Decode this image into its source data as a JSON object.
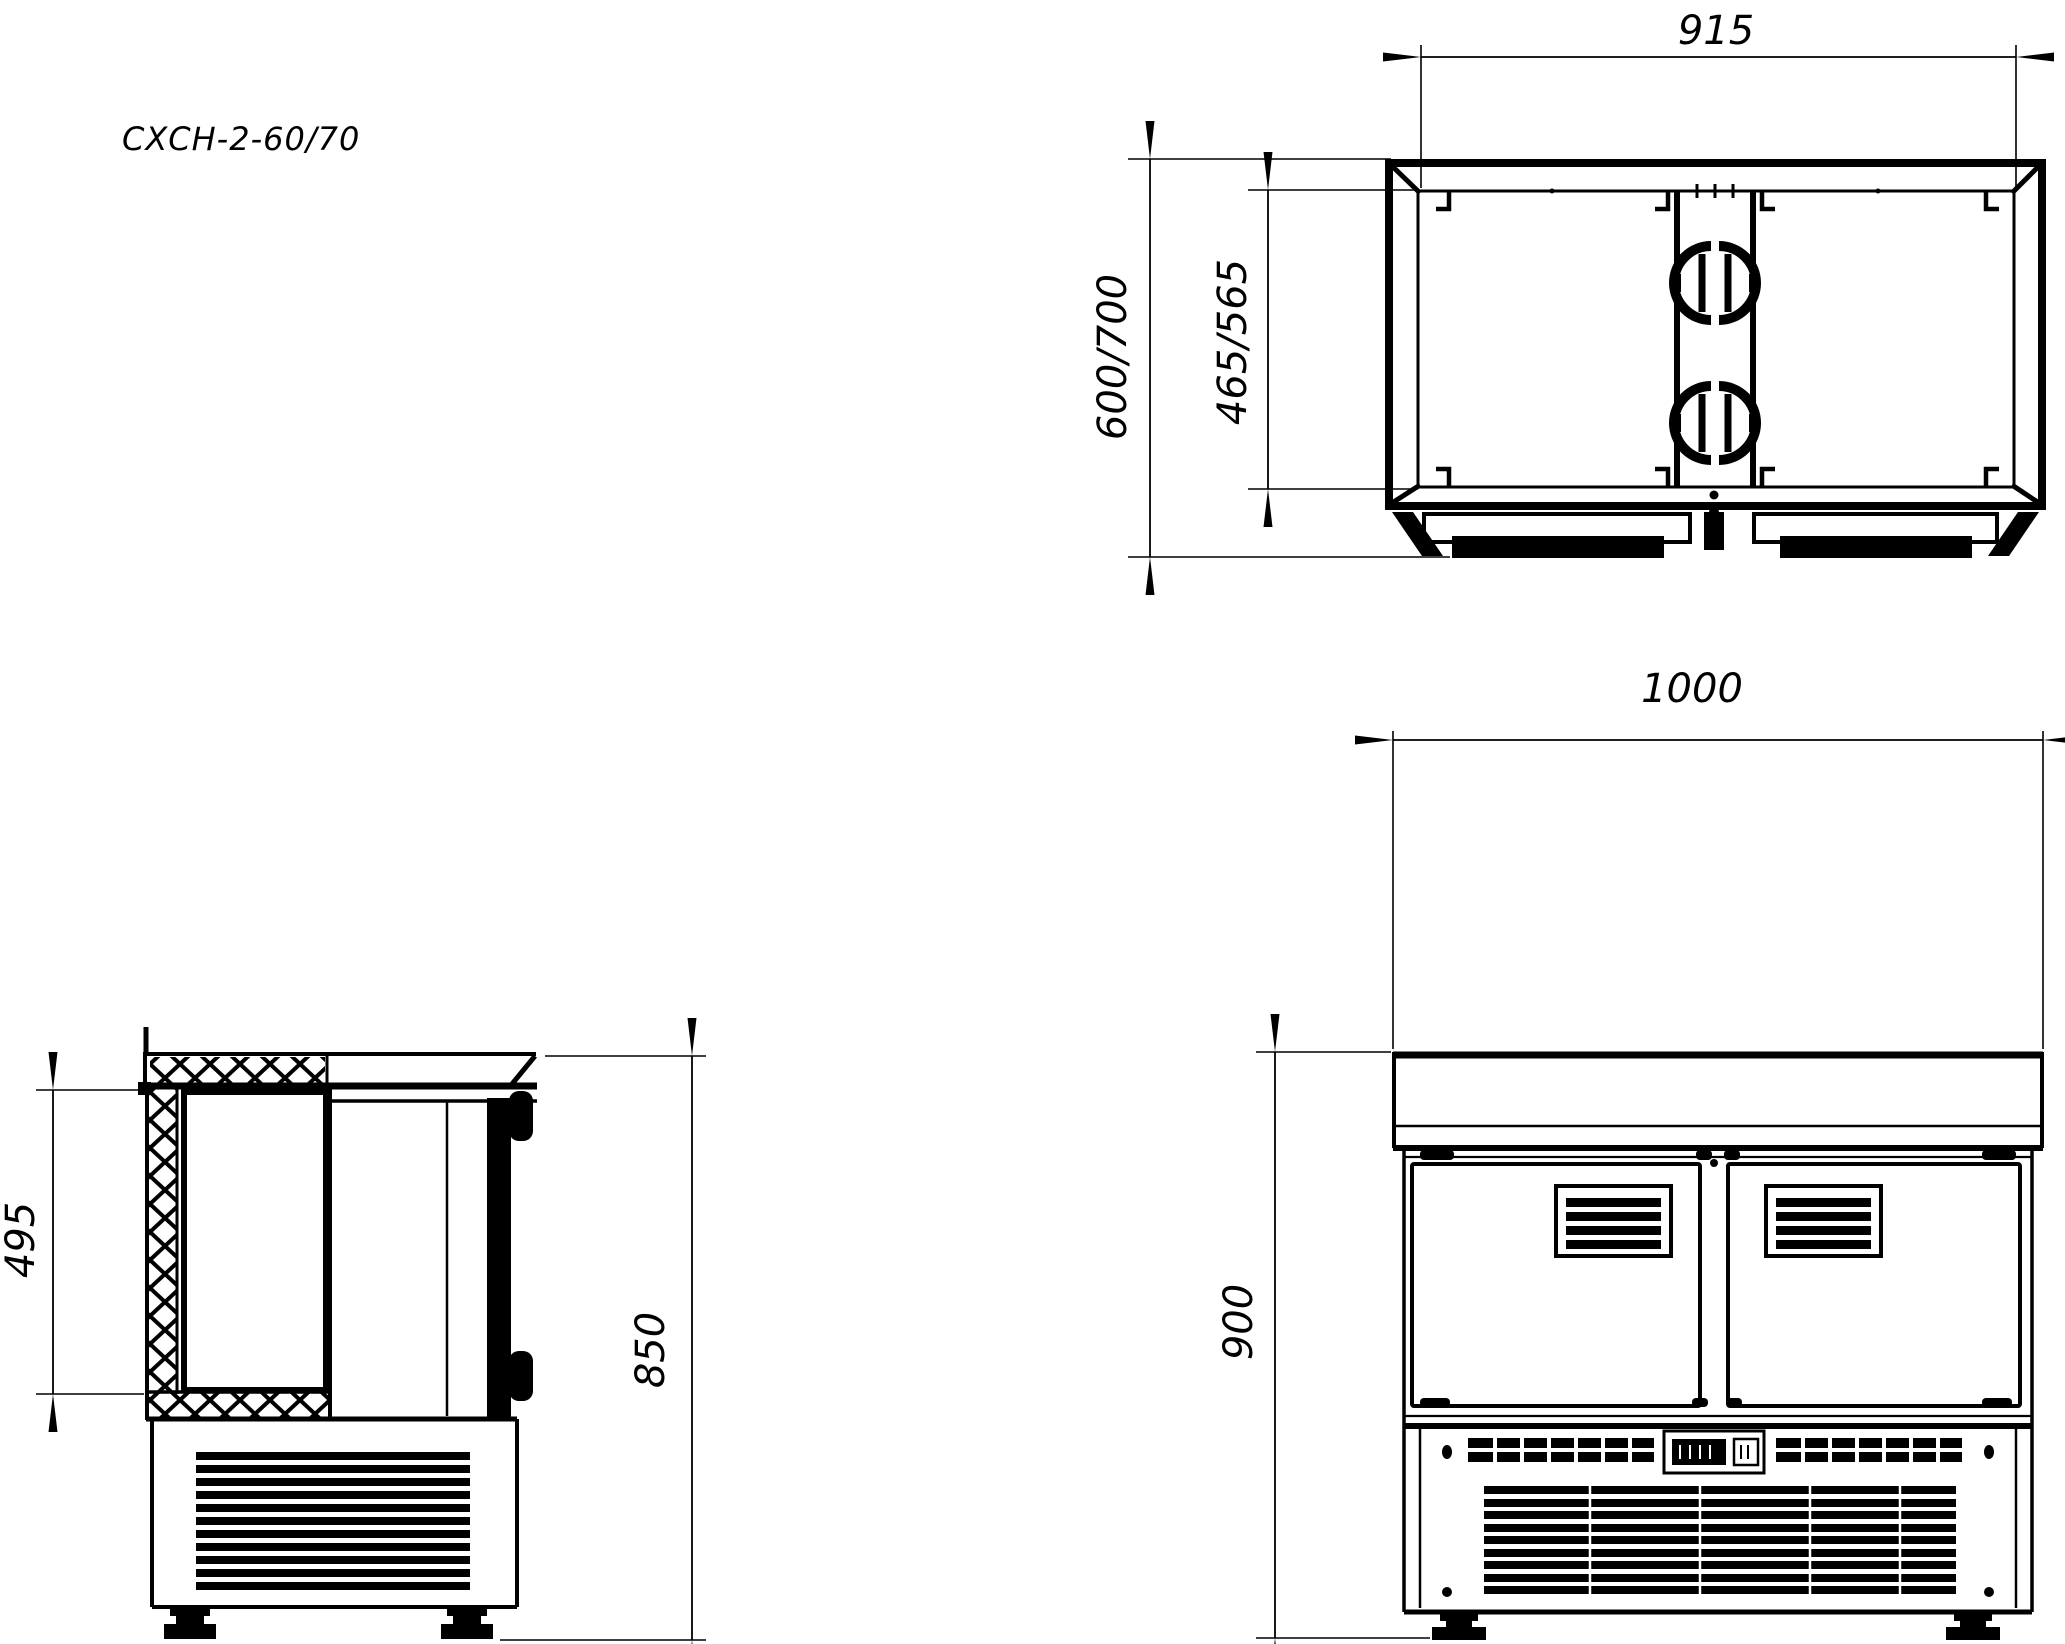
{
  "title": "СХСН-2-60/70",
  "views": {
    "top": {
      "dim_inner_width": "915",
      "dim_depth_overall": "600/700",
      "dim_depth_inner": "465/565"
    },
    "side": {
      "dim_chamber_height": "495",
      "dim_overall_height": "850"
    },
    "front": {
      "dim_overall_width": "1000",
      "dim_overall_height": "900"
    }
  }
}
